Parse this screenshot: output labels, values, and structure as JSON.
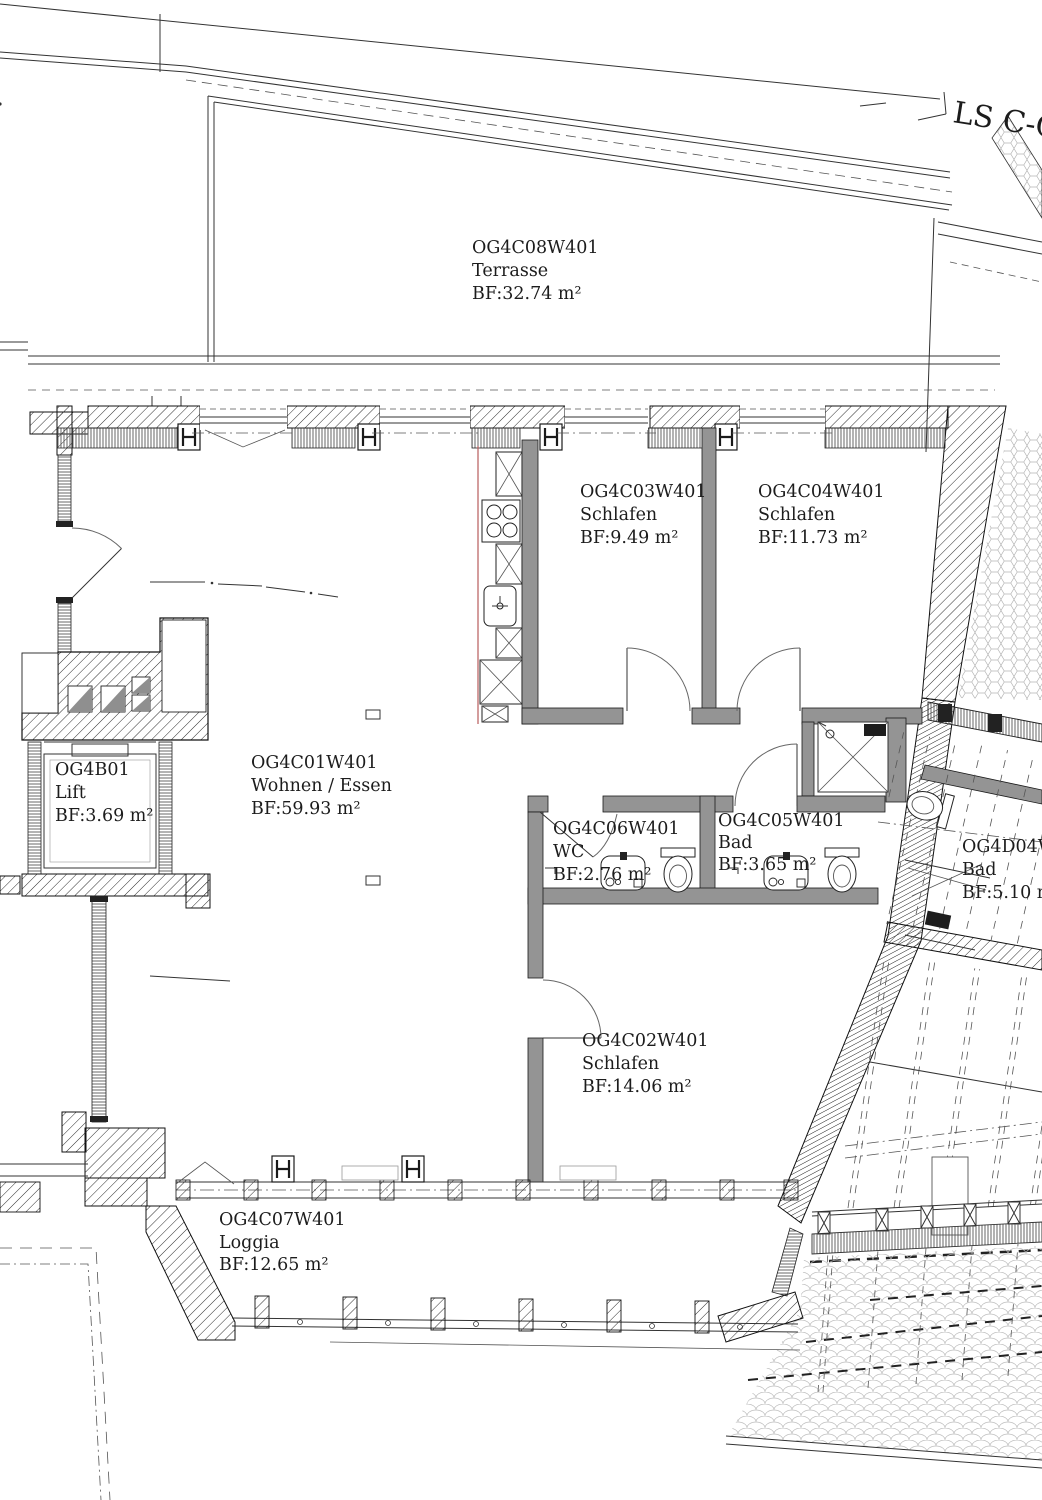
{
  "drawing": {
    "title": "Floor plan (4th upper floor apartment)",
    "annotations": {
      "section_label": "LS C-C"
    },
    "rooms": {
      "terrasse": {
        "id": "OG4C08W401",
        "name": "Terrasse",
        "area": "BF:32.74 m²"
      },
      "schlafen_c03": {
        "id": "OG4C03W401",
        "name": "Schlafen",
        "area": "BF:9.49 m²"
      },
      "schlafen_c04": {
        "id": "OG4C04W401",
        "name": "Schlafen",
        "area": "BF:11.73 m²"
      },
      "lift": {
        "id": "OG4B01",
        "name": "Lift",
        "area": "BF:3.69 m²"
      },
      "wohnen": {
        "id": "OG4C01W401",
        "name": "Wohnen / Essen",
        "area": "BF:59.93 m²"
      },
      "wc": {
        "id": "OG4C06W401",
        "name": "WC",
        "area": "BF:2.76 m²"
      },
      "bad_c05": {
        "id": "OG4C05W401",
        "name": "Bad",
        "area": "BF:3.65 m²"
      },
      "bad_d04": {
        "id": "OG4D04W",
        "name": "Bad",
        "area": "BF:5.10 m"
      },
      "schlafen_c02": {
        "id": "OG4C02W401",
        "name": "Schlafen",
        "area": "BF:14.06 m²"
      },
      "loggia": {
        "id": "OG4C07W401",
        "name": "Loggia",
        "area": "BF:12.65 m²"
      }
    },
    "colors": {
      "line": "#1a1a1a",
      "wall_fill": "#949494",
      "counter_accent": "#b85c5c",
      "background": "#ffffff"
    }
  }
}
